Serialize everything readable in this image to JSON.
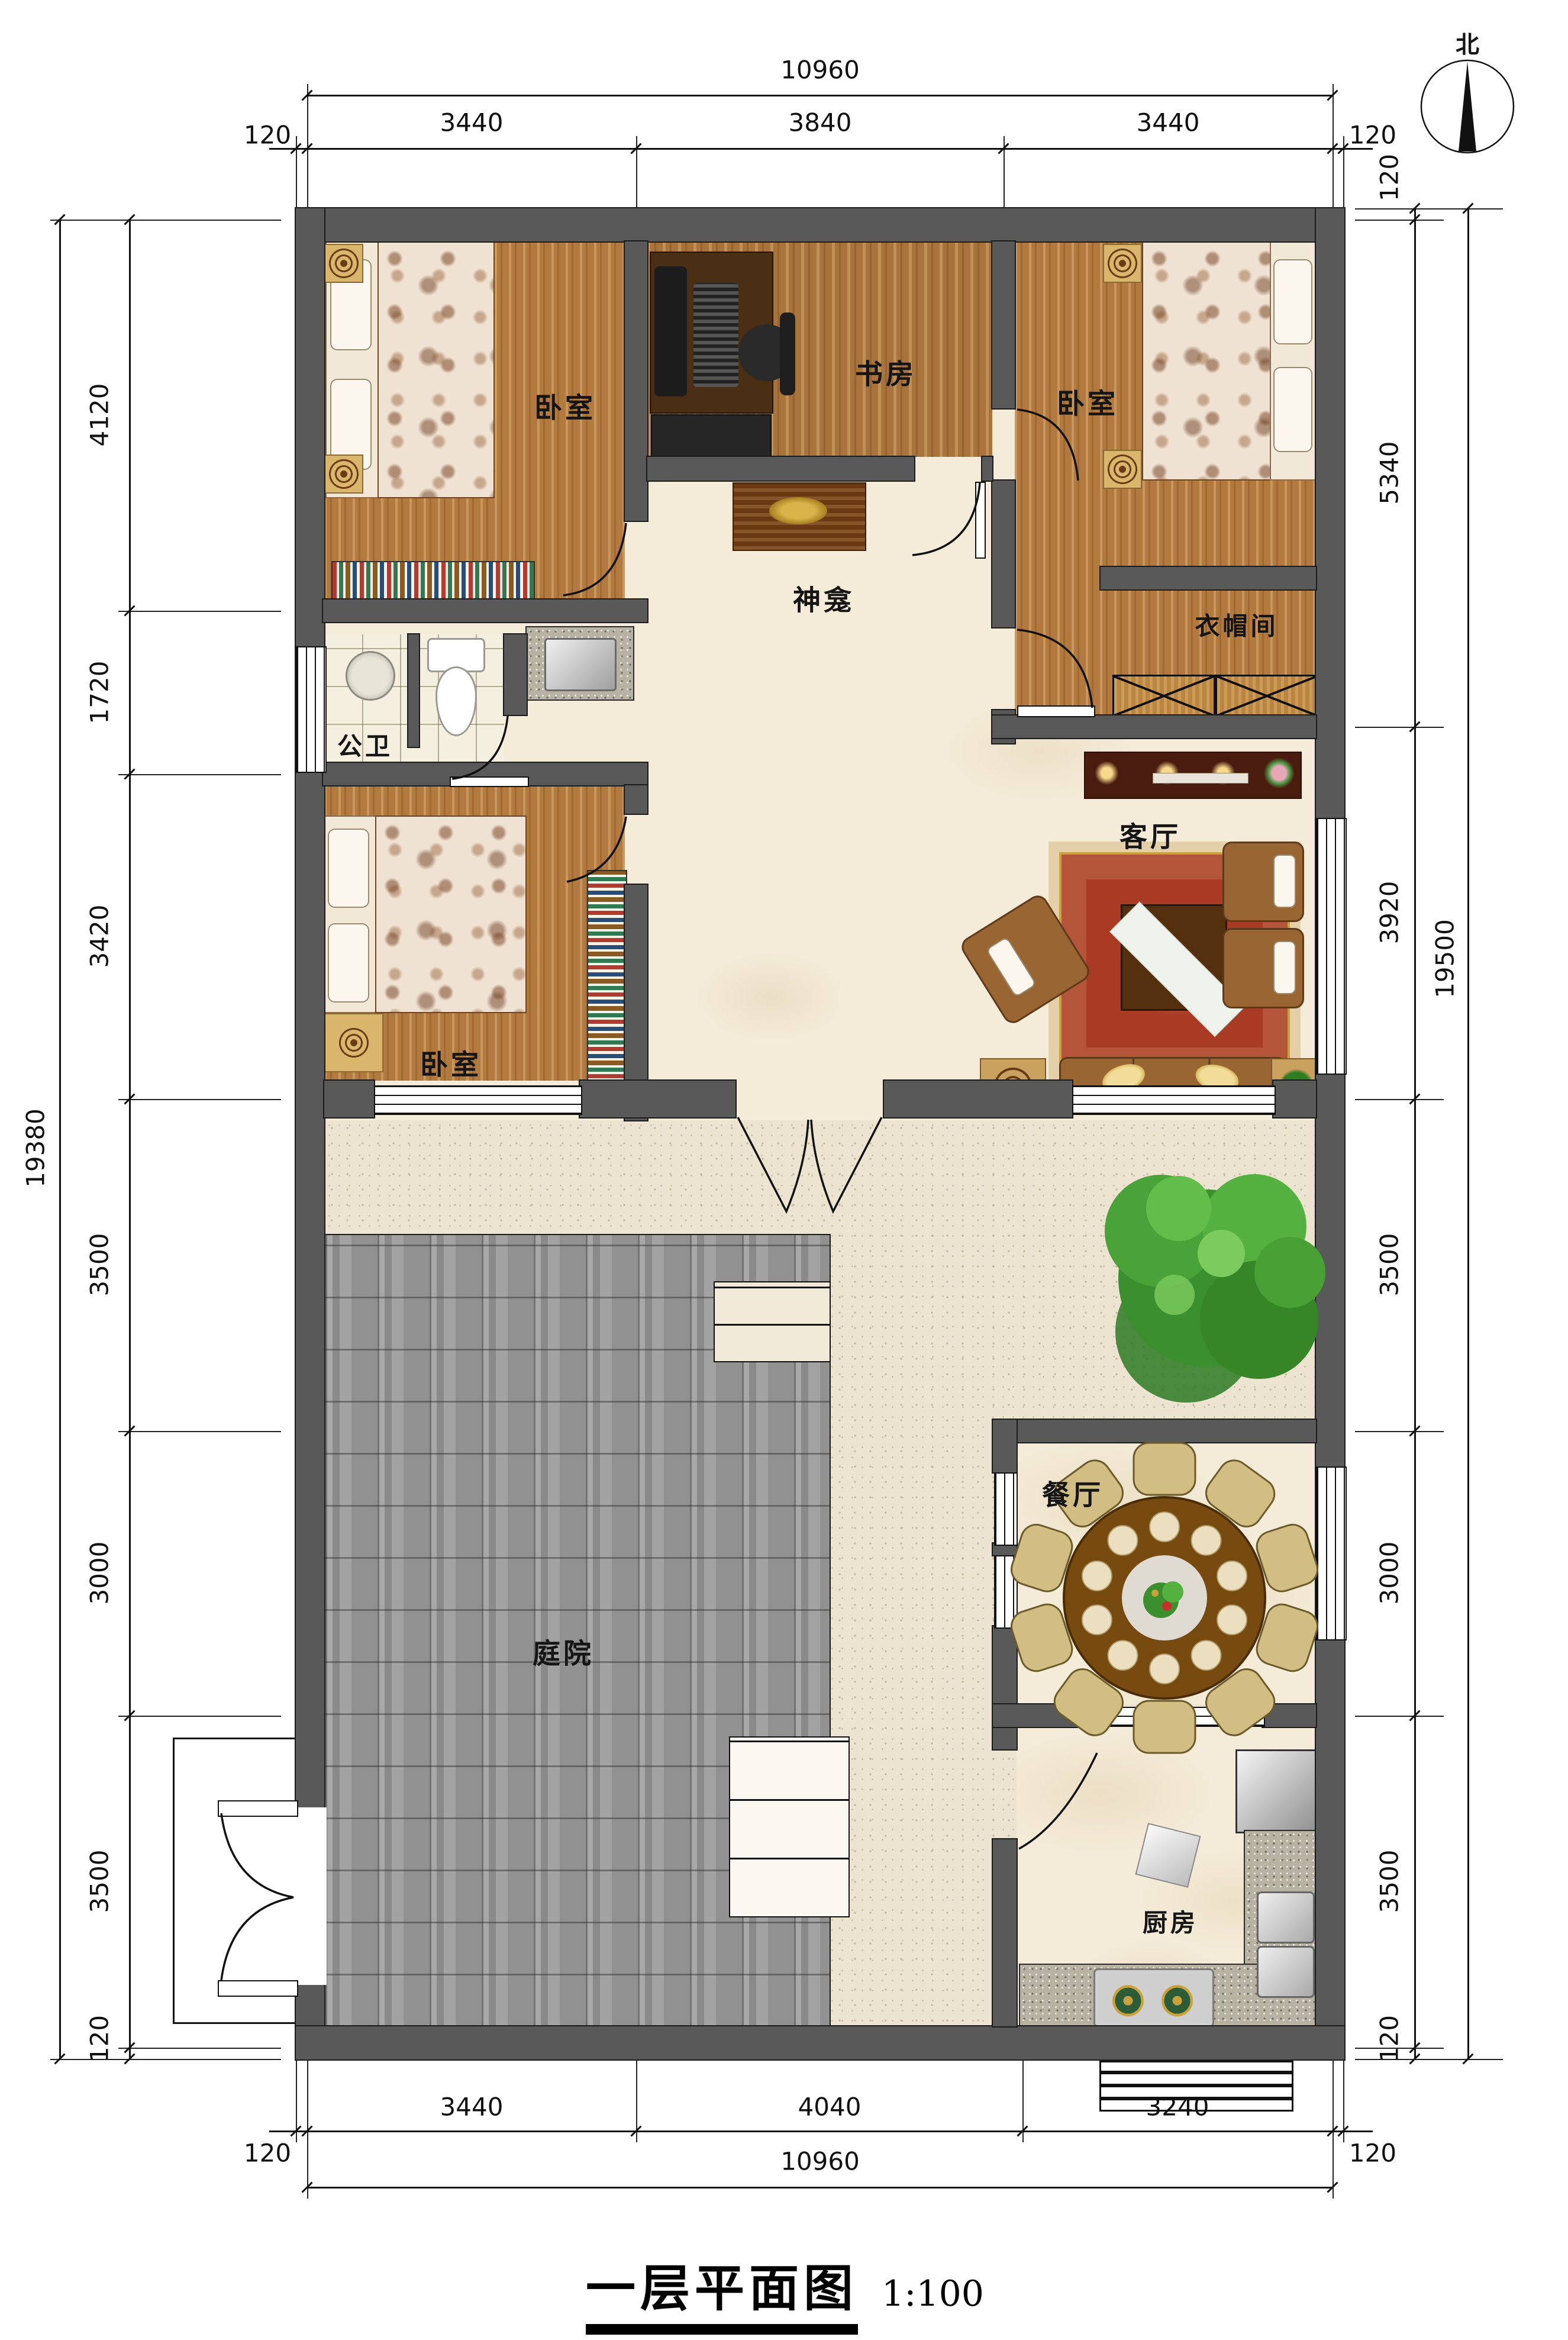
{
  "title": {
    "main": "一层平面图",
    "scale": "1:100"
  },
  "compass": {
    "label": "北"
  },
  "rooms": {
    "bedroom_tl": "卧室",
    "study": "书房",
    "bedroom_tr": "卧室",
    "shrine": "神龛",
    "cloakroom": "衣帽间",
    "bathroom": "公卫",
    "living": "客厅",
    "bedroom_bl": "卧室",
    "courtyard": "庭院",
    "dining": "餐厅",
    "kitchen": "厨房"
  },
  "dimensions": {
    "top": {
      "overall": "10960",
      "segments": [
        "120",
        "3440",
        "3840",
        "3440",
        "120"
      ]
    },
    "bottom": {
      "overall": "10960",
      "segments": [
        "120",
        "3440",
        "4040",
        "3240",
        "120"
      ]
    },
    "left": {
      "overall": "19380",
      "segments": [
        "4120",
        "1720",
        "3420",
        "3500",
        "3000",
        "3500",
        "120"
      ]
    },
    "right": {
      "overall": "19500",
      "segments": [
        "120",
        "5340",
        "3920",
        "3500",
        "3000",
        "3500",
        "120"
      ]
    }
  },
  "colors": {
    "wall": "#595959",
    "wood_floor": "#b27a3e",
    "marble_floor": "#f4ecd9",
    "paving": "#9a9a9a",
    "rug": "#a93b24",
    "sofa": "#996633",
    "accent_gold": "#d9b66c"
  }
}
